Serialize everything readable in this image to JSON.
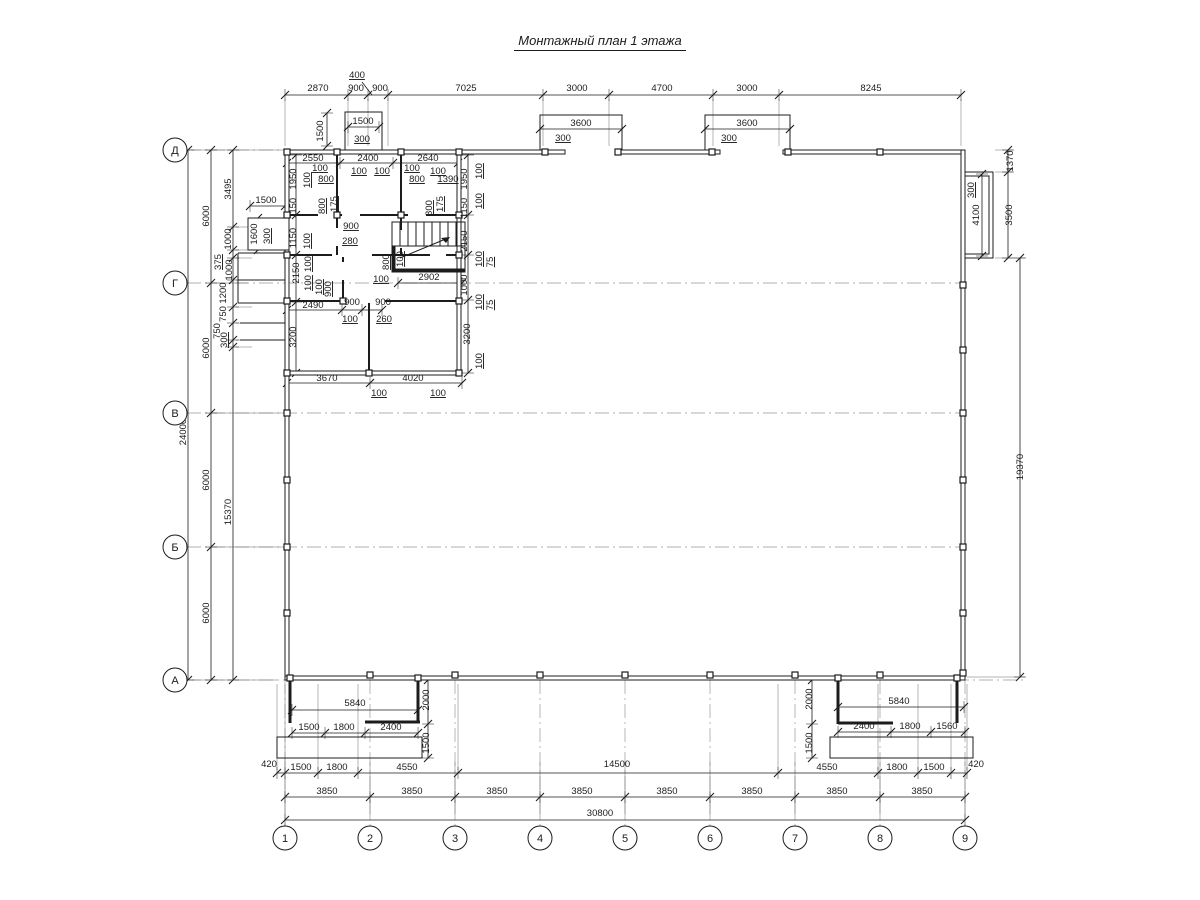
{
  "title": {
    "text": "Монтажный план 1 этажа"
  },
  "colors": {
    "line": "#1c1c1c",
    "ext": "#6b6b6b",
    "axis_line": "#999999",
    "bg": "#ffffff"
  },
  "axis_rows": [
    {
      "label": "Д",
      "y": 150
    },
    {
      "label": "Г",
      "y": 283
    },
    {
      "label": "В",
      "y": 413
    },
    {
      "label": "Б",
      "y": 547
    },
    {
      "label": "А",
      "y": 680
    }
  ],
  "axis_cols": [
    {
      "label": "1",
      "x": 285
    },
    {
      "label": "2",
      "x": 370
    },
    {
      "label": "3",
      "x": 455
    },
    {
      "label": "4",
      "x": 540
    },
    {
      "label": "5",
      "x": 625
    },
    {
      "label": "6",
      "x": 710
    },
    {
      "label": "7",
      "x": 795
    },
    {
      "label": "8",
      "x": 880
    },
    {
      "label": "9",
      "x": 965
    }
  ],
  "dimensions": [
    {
      "t": "2870",
      "x": 318,
      "y": 91
    },
    {
      "t": "400",
      "x": 357,
      "y": 78,
      "u": true
    },
    {
      "t": "900",
      "x": 356,
      "y": 91
    },
    {
      "t": "900",
      "x": 380,
      "y": 91
    },
    {
      "t": "7025",
      "x": 466,
      "y": 91
    },
    {
      "t": "3000",
      "x": 577,
      "y": 91
    },
    {
      "t": "4700",
      "x": 662,
      "y": 91
    },
    {
      "t": "3000",
      "x": 747,
      "y": 91
    },
    {
      "t": "8245",
      "x": 871,
      "y": 91
    },
    {
      "t": "1500",
      "x": 363,
      "y": 124
    },
    {
      "t": "1500",
      "x": 323,
      "y": 131,
      "r": -90
    },
    {
      "t": "300",
      "x": 362,
      "y": 142,
      "u": true
    },
    {
      "t": "3600",
      "x": 581,
      "y": 126
    },
    {
      "t": "300",
      "x": 563,
      "y": 141,
      "u": true
    },
    {
      "t": "3600",
      "x": 747,
      "y": 126
    },
    {
      "t": "300",
      "x": 729,
      "y": 141,
      "u": true
    },
    {
      "t": "1370",
      "x": 1013,
      "y": 161,
      "r": -90
    },
    {
      "t": "300",
      "x": 974,
      "y": 190,
      "r": -90,
      "u": true
    },
    {
      "t": "4100",
      "x": 979,
      "y": 215,
      "r": -90
    },
    {
      "t": "3500",
      "x": 1012,
      "y": 215,
      "r": -90
    },
    {
      "t": "19370",
      "x": 1023,
      "y": 467,
      "r": -90
    },
    {
      "t": "24000",
      "x": 186,
      "y": 432,
      "r": -90
    },
    {
      "t": "6000",
      "x": 209,
      "y": 216,
      "r": -90
    },
    {
      "t": "6000",
      "x": 209,
      "y": 348,
      "r": -90
    },
    {
      "t": "6000",
      "x": 209,
      "y": 480,
      "r": -90
    },
    {
      "t": "6000",
      "x": 209,
      "y": 613,
      "r": -90
    },
    {
      "t": "3495",
      "x": 231,
      "y": 189,
      "r": -90
    },
    {
      "t": "1000",
      "x": 231,
      "y": 239,
      "r": -90
    },
    {
      "t": "375",
      "x": 221,
      "y": 262,
      "r": -90,
      "u": true
    },
    {
      "t": "1000",
      "x": 232,
      "y": 270,
      "r": -90
    },
    {
      "t": "1200",
      "x": 226,
      "y": 293,
      "r": -90
    },
    {
      "t": "750",
      "x": 226,
      "y": 314,
      "r": -90
    },
    {
      "t": "750",
      "x": 220,
      "y": 331,
      "r": -90
    },
    {
      "t": "300",
      "x": 227,
      "y": 340,
      "r": -90,
      "u": true
    },
    {
      "t": "15370",
      "x": 231,
      "y": 512,
      "r": -90
    },
    {
      "t": "1500",
      "x": 266,
      "y": 203
    },
    {
      "t": "1600",
      "x": 257,
      "y": 234,
      "r": -90
    },
    {
      "t": "300",
      "x": 270,
      "y": 236,
      "r": -90,
      "u": true
    },
    {
      "t": "2550",
      "x": 313,
      "y": 161
    },
    {
      "t": "2400",
      "x": 368,
      "y": 161
    },
    {
      "t": "2640",
      "x": 428,
      "y": 161
    },
    {
      "t": "1950",
      "x": 296,
      "y": 179,
      "r": -90
    },
    {
      "t": "1950",
      "x": 467,
      "y": 179,
      "r": -90
    },
    {
      "t": "100",
      "x": 320,
      "y": 171,
      "u": true
    },
    {
      "t": "800",
      "x": 326,
      "y": 182,
      "u": true
    },
    {
      "t": "100",
      "x": 359,
      "y": 174,
      "u": true
    },
    {
      "t": "100",
      "x": 382,
      "y": 174,
      "u": true
    },
    {
      "t": "100",
      "x": 412,
      "y": 171,
      "u": true
    },
    {
      "t": "800",
      "x": 417,
      "y": 182,
      "u": true
    },
    {
      "t": "100",
      "x": 438,
      "y": 174,
      "u": true
    },
    {
      "t": "1390",
      "x": 448,
      "y": 182,
      "u": true
    },
    {
      "t": "100",
      "x": 310,
      "y": 180,
      "r": -90,
      "u": true
    },
    {
      "t": "1150",
      "x": 296,
      "y": 208,
      "r": -90
    },
    {
      "t": "800",
      "x": 325,
      "y": 206,
      "r": -90,
      "u": true
    },
    {
      "t": "175",
      "x": 337,
      "y": 204,
      "r": -90,
      "u": true
    },
    {
      "t": "800",
      "x": 432,
      "y": 208,
      "r": -90,
      "u": true
    },
    {
      "t": "175",
      "x": 443,
      "y": 204,
      "r": -90,
      "u": true
    },
    {
      "t": "1150",
      "x": 467,
      "y": 208,
      "r": -90
    },
    {
      "t": "100",
      "x": 482,
      "y": 171,
      "r": -90,
      "u": true
    },
    {
      "t": "100",
      "x": 482,
      "y": 201,
      "r": -90,
      "u": true
    },
    {
      "t": "1150",
      "x": 296,
      "y": 238,
      "r": -90
    },
    {
      "t": "100",
      "x": 310,
      "y": 241,
      "r": -90,
      "u": true
    },
    {
      "t": "900",
      "x": 351,
      "y": 229,
      "u": true
    },
    {
      "t": "280",
      "x": 350,
      "y": 244,
      "u": true
    },
    {
      "t": "2150",
      "x": 467,
      "y": 241,
      "r": -90
    },
    {
      "t": "100",
      "x": 482,
      "y": 259,
      "r": -90,
      "u": true
    },
    {
      "t": "75",
      "x": 493,
      "y": 262,
      "r": -90,
      "u": true
    },
    {
      "t": "800",
      "x": 389,
      "y": 262,
      "r": -90,
      "u": true
    },
    {
      "t": "100",
      "x": 403,
      "y": 259,
      "r": -90,
      "u": true
    },
    {
      "t": "100",
      "x": 381,
      "y": 282,
      "u": true
    },
    {
      "t": "2902",
      "x": 429,
      "y": 280
    },
    {
      "t": "2150",
      "x": 299,
      "y": 273,
      "r": -90
    },
    {
      "t": "100",
      "x": 311,
      "y": 264,
      "r": -90,
      "u": true
    },
    {
      "t": "100",
      "x": 311,
      "y": 283,
      "r": -90,
      "u": true
    },
    {
      "t": "100",
      "x": 322,
      "y": 287,
      "r": -90,
      "u": true
    },
    {
      "t": "900",
      "x": 331,
      "y": 289,
      "r": -90,
      "u": true
    },
    {
      "t": "1000",
      "x": 467,
      "y": 285,
      "r": -90
    },
    {
      "t": "100",
      "x": 482,
      "y": 302,
      "r": -90,
      "u": true
    },
    {
      "t": "75",
      "x": 493,
      "y": 305,
      "r": -90,
      "u": true
    },
    {
      "t": "2490",
      "x": 313,
      "y": 308
    },
    {
      "t": "900",
      "x": 352,
      "y": 305
    },
    {
      "t": "900",
      "x": 383,
      "y": 305
    },
    {
      "t": "100",
      "x": 350,
      "y": 322,
      "u": true
    },
    {
      "t": "260",
      "x": 384,
      "y": 322,
      "u": true
    },
    {
      "t": "3200",
      "x": 296,
      "y": 337,
      "r": -90
    },
    {
      "t": "3200",
      "x": 470,
      "y": 334,
      "r": -90
    },
    {
      "t": "100",
      "x": 482,
      "y": 361,
      "r": -90,
      "u": true
    },
    {
      "t": "3670",
      "x": 327,
      "y": 381
    },
    {
      "t": "4020",
      "x": 413,
      "y": 381
    },
    {
      "t": "100",
      "x": 379,
      "y": 396,
      "u": true
    },
    {
      "t": "100",
      "x": 438,
      "y": 396,
      "u": true
    },
    {
      "t": "5840",
      "x": 355,
      "y": 706
    },
    {
      "t": "2000",
      "x": 429,
      "y": 700,
      "r": -90
    },
    {
      "t": "1500",
      "x": 429,
      "y": 743,
      "r": -90
    },
    {
      "t": "1500",
      "x": 309,
      "y": 730
    },
    {
      "t": "1800",
      "x": 344,
      "y": 730
    },
    {
      "t": "2400",
      "x": 391,
      "y": 730
    },
    {
      "t": "5840",
      "x": 899,
      "y": 704
    },
    {
      "t": "2000",
      "x": 812,
      "y": 699,
      "r": -90
    },
    {
      "t": "1500",
      "x": 812,
      "y": 743,
      "r": -90
    },
    {
      "t": "2400",
      "x": 864,
      "y": 729
    },
    {
      "t": "1800",
      "x": 910,
      "y": 729
    },
    {
      "t": "1560",
      "x": 947,
      "y": 729
    },
    {
      "t": "420",
      "x": 269,
      "y": 767
    },
    {
      "t": "1500",
      "x": 301,
      "y": 770
    },
    {
      "t": "1800",
      "x": 337,
      "y": 770
    },
    {
      "t": "4550",
      "x": 407,
      "y": 770
    },
    {
      "t": "14500",
      "x": 617,
      "y": 767
    },
    {
      "t": "4550",
      "x": 827,
      "y": 770
    },
    {
      "t": "1800",
      "x": 897,
      "y": 770
    },
    {
      "t": "1500",
      "x": 934,
      "y": 770
    },
    {
      "t": "420",
      "x": 976,
      "y": 767
    },
    {
      "t": "3850",
      "x": 327,
      "y": 794
    },
    {
      "t": "3850",
      "x": 412,
      "y": 794
    },
    {
      "t": "3850",
      "x": 497,
      "y": 794
    },
    {
      "t": "3850",
      "x": 582,
      "y": 794
    },
    {
      "t": "3850",
      "x": 667,
      "y": 794
    },
    {
      "t": "3850",
      "x": 752,
      "y": 794
    },
    {
      "t": "3850",
      "x": 837,
      "y": 794
    },
    {
      "t": "3850",
      "x": 922,
      "y": 794
    },
    {
      "t": "30800",
      "x": 600,
      "y": 816
    }
  ]
}
